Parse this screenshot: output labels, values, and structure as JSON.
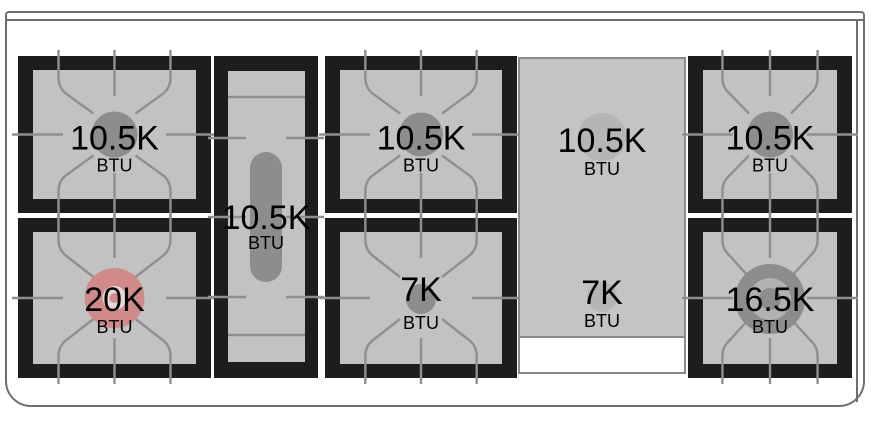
{
  "cooktop": {
    "description": "Gas range cooktop burner layout diagram with BTU ratings",
    "unit": "BTU",
    "burners": [
      {
        "name": "rear-left",
        "power": "10.5K",
        "unit": "BTU",
        "type": "round-burner"
      },
      {
        "name": "front-left",
        "power": "20K",
        "unit": "BTU",
        "type": "round-burner-highlighted"
      },
      {
        "name": "center-oval",
        "power": "10.5K",
        "unit": "BTU",
        "type": "oval-burner"
      },
      {
        "name": "rear-center",
        "power": "10.5K",
        "unit": "BTU",
        "type": "round-burner"
      },
      {
        "name": "front-center",
        "power": "7K",
        "unit": "BTU",
        "type": "round-burner"
      },
      {
        "name": "griddle-rear",
        "power": "10.5K",
        "unit": "BTU",
        "type": "griddle-burner"
      },
      {
        "name": "griddle-front",
        "power": "7K",
        "unit": "BTU",
        "type": "griddle-burner"
      },
      {
        "name": "rear-right",
        "power": "10.5K",
        "unit": "BTU",
        "type": "round-burner"
      },
      {
        "name": "front-right",
        "power": "16.5K",
        "unit": "BTU",
        "type": "dual-ring-burner"
      }
    ],
    "colors": {
      "background": "#ffffff",
      "outline": "#6f6f6f",
      "frame": "#1d1d1d",
      "bed": "#c2c2c2",
      "grate": "#8f8f8f",
      "burner_dark": "#8d8d8d",
      "burner_light": "#b5b5b5",
      "ring_light": "#b2b2b2",
      "highlight_red": "#d08a89",
      "highlight_red_light": "#e7d8d6",
      "panel": "#c4c4c4",
      "panel_border": "#8a8a8a",
      "text": "#000000"
    }
  }
}
